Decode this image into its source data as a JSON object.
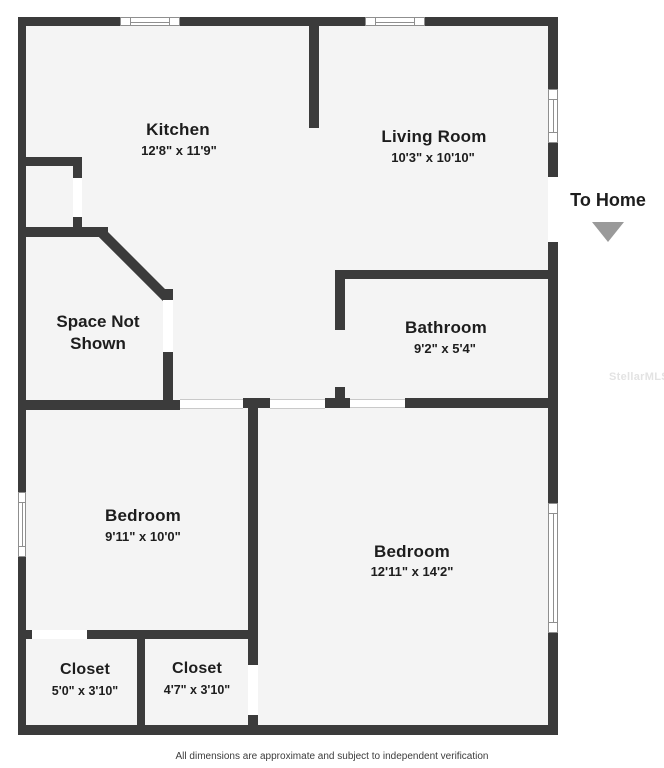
{
  "floorplan": {
    "rooms": [
      {
        "id": "kitchen",
        "label": "Kitchen",
        "dims": "12'8\" x 11'9\""
      },
      {
        "id": "living-room",
        "label": "Living Room",
        "dims": "10'3\" x 10'10\""
      },
      {
        "id": "bathroom",
        "label": "Bathroom",
        "dims": "9'2\" x 5'4\""
      },
      {
        "id": "space-not-shown",
        "label": "Space Not Shown",
        "dims": ""
      },
      {
        "id": "bedroom-1",
        "label": "Bedroom",
        "dims": "9'11\" x 10'0\""
      },
      {
        "id": "bedroom-2",
        "label": "Bedroom",
        "dims": "12'11\" x 14'2\""
      },
      {
        "id": "closet-1",
        "label": "Closet",
        "dims": "5'0\" x 3'10\""
      },
      {
        "id": "closet-2",
        "label": "Closet",
        "dims": "4'7\" x 3'10\""
      }
    ],
    "annotations": {
      "to_home": "To Home",
      "arrow_icon": "triangle-down"
    },
    "watermark": "StellarMLS",
    "footer": "All dimensions are approximate and subject to independent verification",
    "colors": {
      "wall": "#3b3b3b",
      "floor": "#f4f4f4",
      "background": "#ffffff",
      "arrow": "#9a9a9a",
      "watermark": "#e3e3e3"
    }
  }
}
